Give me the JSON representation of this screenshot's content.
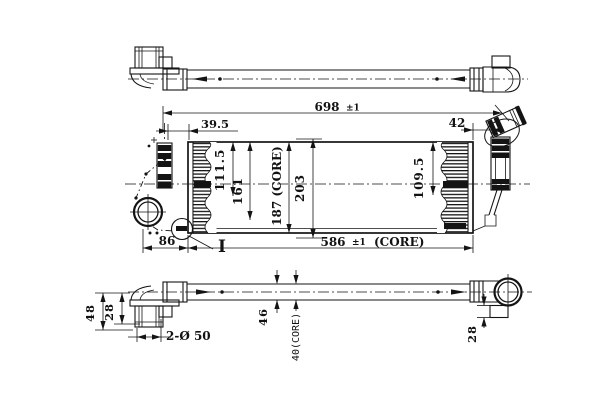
{
  "drawing": {
    "front": {
      "overall_width": "698",
      "overall_width_tolerance": "±1",
      "left_end_width": "39.5",
      "right_end_width": "42",
      "height_111_5": "111.5",
      "height_161": "161",
      "core_height": "187  (CORE)",
      "overall_height": "203",
      "height_109_5": "109.5",
      "port_offset": "86",
      "core_width": "586",
      "core_width_tolerance": "±1",
      "core_width_suffix": "(CORE)",
      "detail_marker": "I"
    },
    "bottom": {
      "depth_48": "48",
      "depth_28_left": "28",
      "port_spec": "2-Ø 50",
      "depth_46": "46",
      "core_depth": "40(CORE)",
      "depth_28_right": "28"
    }
  }
}
